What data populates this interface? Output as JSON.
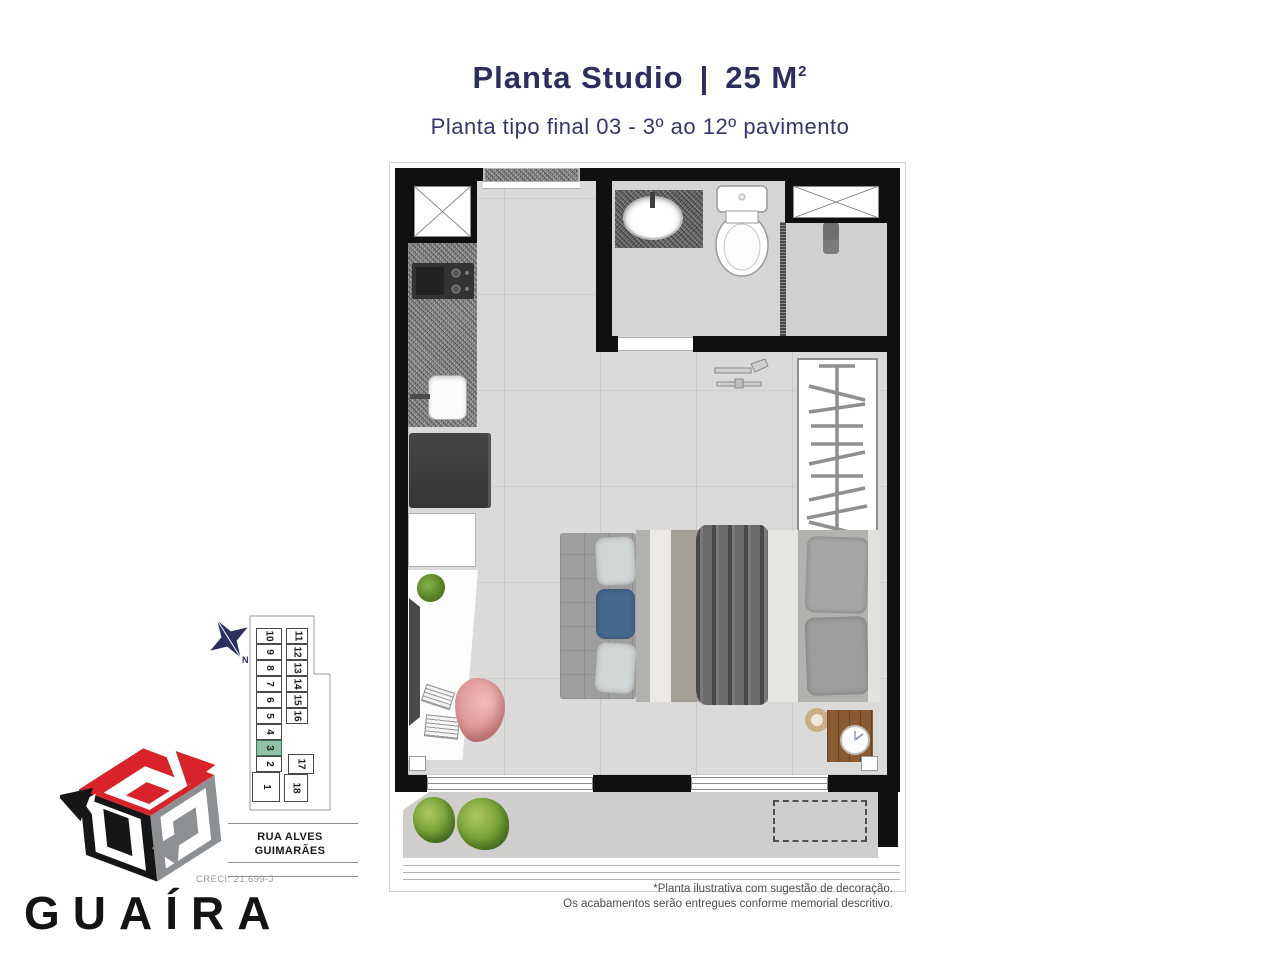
{
  "header": {
    "title_left": "Planta Studio",
    "title_sep": "|",
    "title_area": "25 M",
    "title_sup": "2",
    "subtitle": "Planta tipo final 03 - 3º ao 12º pavimento"
  },
  "keyplan": {
    "compass_label": "N",
    "units": [
      "1",
      "2",
      "3",
      "4",
      "5",
      "6",
      "7",
      "8",
      "9",
      "10",
      "11",
      "12",
      "13",
      "14",
      "15",
      "16",
      "17",
      "18"
    ],
    "highlighted_unit": "3",
    "street_line1": "RUA ALVES",
    "street_line2": "GUIMARÃES"
  },
  "logo": {
    "brand": "GUAÍRA",
    "creci": "CRECI: 21.699-J"
  },
  "footnote": {
    "line1": "*Planta ilustrativa com sugestão de decoração.",
    "line2": "Os acabamentos serão entregues conforme memorial descritivo."
  },
  "colors": {
    "accent_navy": "#2b2e5f",
    "highlight_green": "#8fc2a9",
    "logo_red": "#d8232a",
    "wall_black": "#101010"
  }
}
